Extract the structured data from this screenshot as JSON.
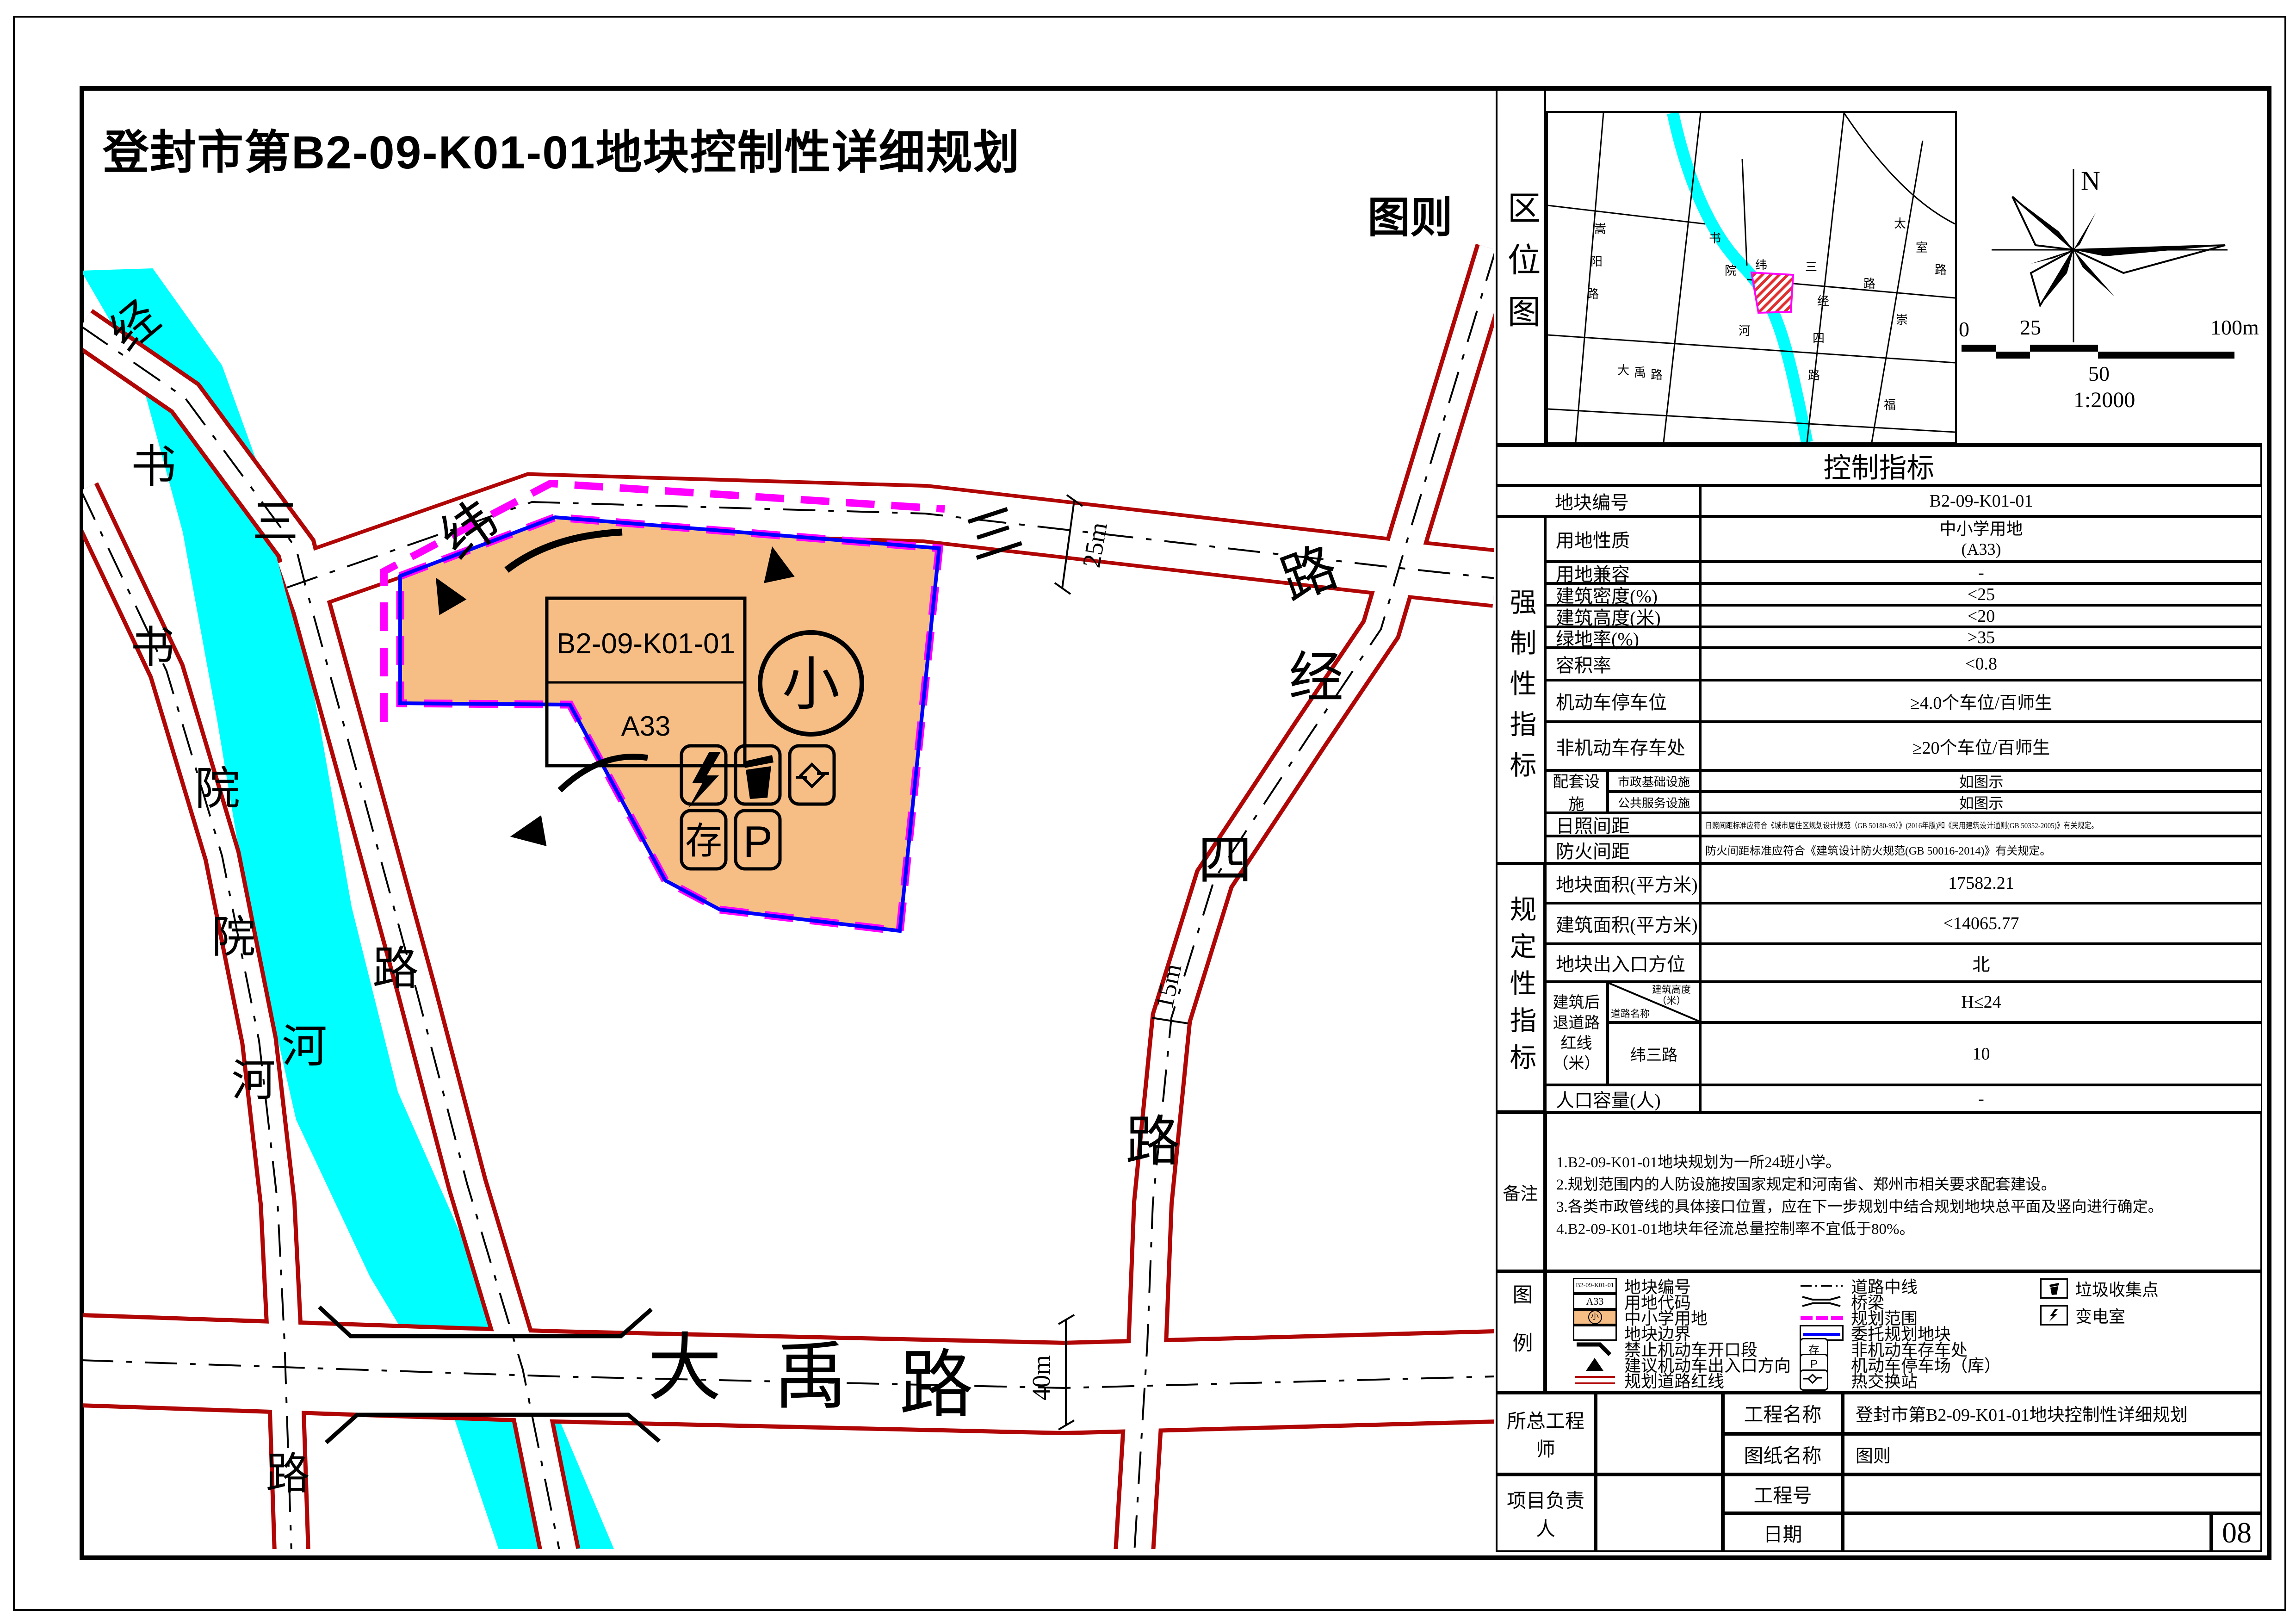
{
  "title": "登封市第B2-09-K01-01地块控制性详细规划",
  "sheet_label": "图则",
  "page_number": "08",
  "colors": {
    "road_red": "#B00606",
    "river_cyan": "#00FFFF",
    "parcel_orange": "#F6BE85",
    "scope_magenta": "#FF00FF",
    "entrust_blue": "#0000FF"
  },
  "location_map": {
    "label": "区位图",
    "names": {
      "songyang": "嵩阳路",
      "shuyuanhe": "书院河",
      "dayu": "大禹路",
      "taishi": "太室路",
      "chongfu": "崇福路",
      "weisan": "纬三路",
      "jingsi": "经四路"
    }
  },
  "compass": {
    "north": "N"
  },
  "scale_bar": {
    "zero": "0",
    "t25": "25",
    "t50": "50",
    "t100": "100m",
    "ratio": "1:2000"
  },
  "map": {
    "parcel": {
      "code": "B2-09-K01-01",
      "land_code": "A33",
      "school_mark": "小",
      "storage_mark": "存",
      "parking_mark": "P"
    },
    "roads": {
      "weisan": "纬三路",
      "jingsi": "经四路",
      "dayu": "大禹路",
      "jingsan": "经三路",
      "westroad": "书院河路",
      "river": "书院河"
    },
    "dims": {
      "weisan": "25m",
      "jingsi": "15m",
      "dayu": "40m"
    }
  },
  "control_table": {
    "header": "控制指标",
    "groups": {
      "mandatory": "强制性指标",
      "regulatory": "规定性指标"
    },
    "rows": {
      "code": {
        "label": "地块编号",
        "value": "B2-09-K01-01"
      },
      "use": {
        "label": "用地性质",
        "value": "中小学用地",
        "value2": "(A33)"
      },
      "compat": {
        "label": "用地兼容",
        "value": "-"
      },
      "density": {
        "label": "建筑密度(%)",
        "value": "<25"
      },
      "height": {
        "label": "建筑高度(米)",
        "value": "<20"
      },
      "green": {
        "label": "绿地率(%)",
        "value": ">35"
      },
      "far": {
        "label": "容积率",
        "value": "<0.8"
      },
      "parking": {
        "label": "机动车停车位",
        "value": "≥4.0个车位/百师生"
      },
      "bike": {
        "label": "非机动车存车处",
        "value": "≥20个车位/百师生"
      },
      "sunlight": {
        "label": "日照间距",
        "value": "日照间距标准应符合《城市居住区规划设计规范（GB 50180-93）》(2016年版)和《民用建筑设计通则(GB 50352-2005)》有关规定。"
      },
      "fire": {
        "label": "防火间距",
        "value": "防火间距标准应符合《建筑设计防火规范(GB 50016-2014)》有关规定。"
      },
      "area": {
        "label": "地块面积(平方米)",
        "value": "17582.21"
      },
      "floor_area": {
        "label": "建筑面积(平方米)",
        "value": "<14065.77"
      },
      "entrance": {
        "label": "地块出入口方位",
        "value": "北"
      },
      "population": {
        "label": "人口容量(人)",
        "value": "-"
      }
    },
    "peitao": {
      "label": "配套设施",
      "sub1": "市政基础设施",
      "sub2": "公共服务设施",
      "v1": "如图示",
      "v2": "如图示"
    },
    "setback": {
      "label": "建筑后退道路红线（米）",
      "diag_top": "建筑高度（米）",
      "diag_bottom": "道路名称",
      "col_value": "H≤24",
      "road": "纬三路",
      "value": "10"
    }
  },
  "remarks": {
    "label": "备注",
    "lines": [
      "1.B2-09-K01-01地块规划为一所24班小学。",
      "2.规划范围内的人防设施按国家规定和河南省、郑州市相关要求配套建设。",
      "3.各类市政管线的具体接口位置，应在下一步规划中结合规划地块总平面及竖向进行确定。",
      "4.B2-09-K01-01地块年径流总量控制率不宜低于80%。"
    ]
  },
  "legend": {
    "label": "图例",
    "col1": [
      {
        "label": "地块编号",
        "swatch_text": "B2-09-K01-01"
      },
      {
        "label": "用地代码",
        "swatch_text": "A33"
      },
      {
        "label": "中小学用地",
        "swatch_text": "小"
      },
      {
        "label": "地块边界"
      },
      {
        "label": "禁止机动车开口段"
      },
      {
        "label": "建议机动车出入口方向"
      },
      {
        "label": "规划道路红线"
      }
    ],
    "col2": [
      {
        "label": "道路中线"
      },
      {
        "label": "桥梁"
      },
      {
        "label": "规划范围"
      },
      {
        "label": "委托规划地块"
      },
      {
        "label": "非机动车存车处",
        "swatch_text": "存"
      },
      {
        "label": "机动车停车场（库）",
        "swatch_text": "P"
      },
      {
        "label": "热交换站"
      }
    ],
    "col3": [
      {
        "label": "垃圾收集点"
      },
      {
        "label": "变电室"
      }
    ]
  },
  "title_block": {
    "chief_engineer": "所总工程师",
    "project_leader": "项目负责人",
    "project_name_label": "工程名称",
    "project_name_value": "登封市第B2-09-K01-01地块控制性详细规划",
    "drawing_name_label": "图纸名称",
    "drawing_name_value": "图则",
    "project_no_label": "工程号",
    "date_label": "日期"
  }
}
